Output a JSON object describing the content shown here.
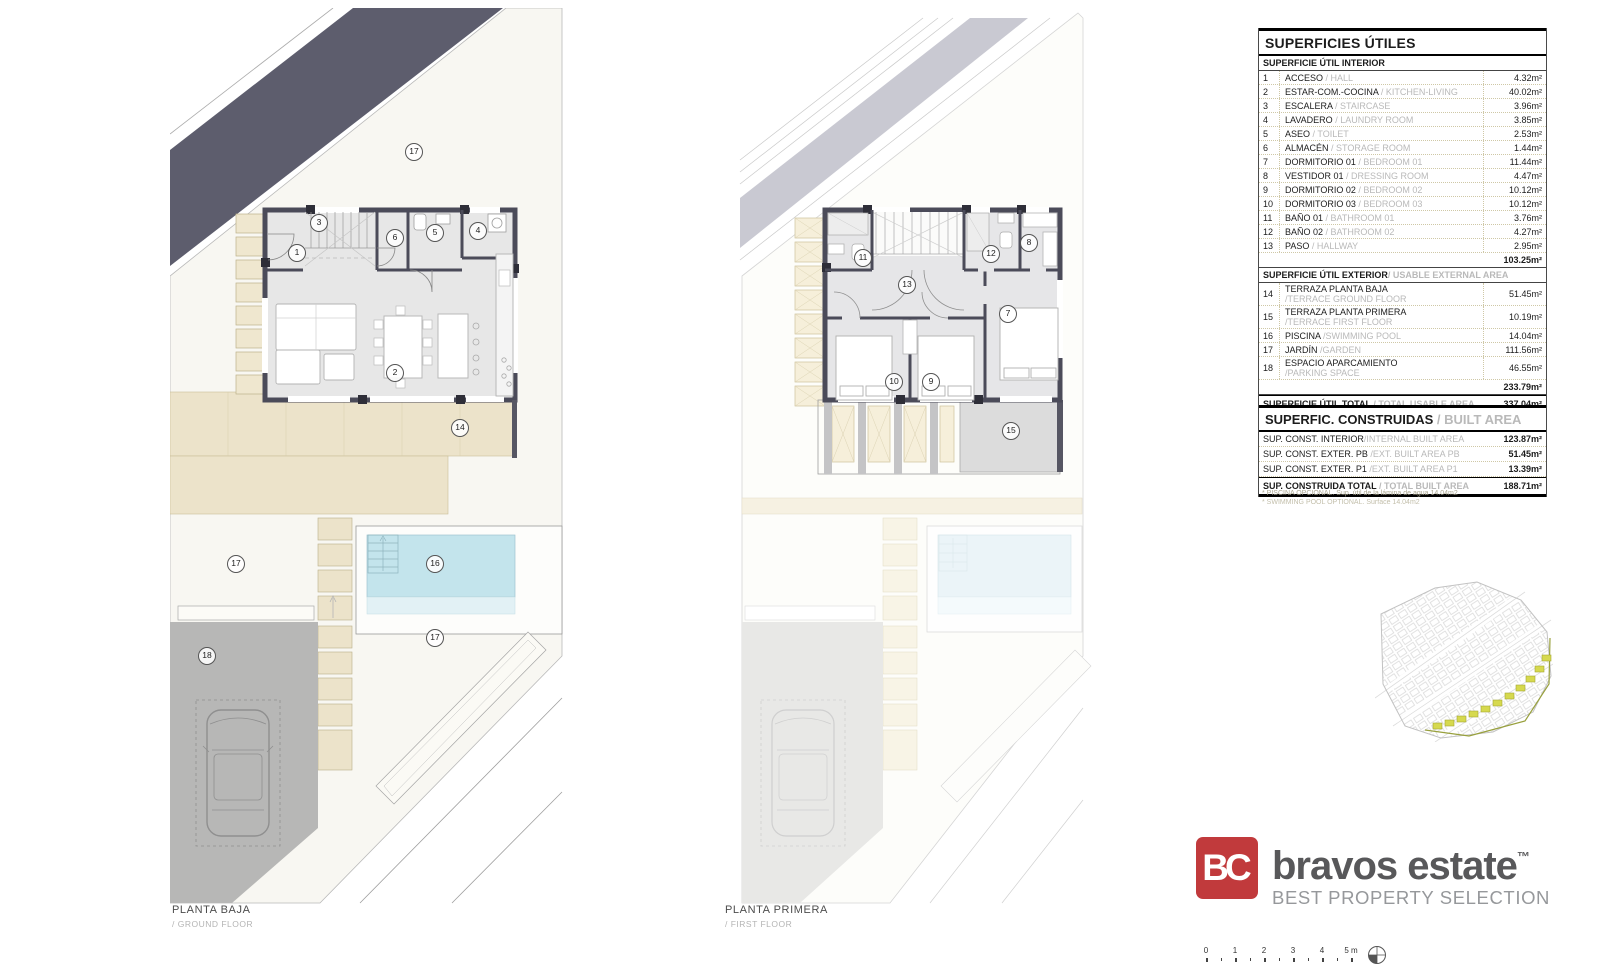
{
  "plans": {
    "ground": {
      "title": "PLANTA BAJA",
      "subtitle": "/ GROUND FLOOR",
      "markers": [
        {
          "n": "17",
          "x": 243,
          "y": 143
        },
        {
          "n": "1",
          "x": 126,
          "y": 244
        },
        {
          "n": "3",
          "x": 148,
          "y": 214
        },
        {
          "n": "6",
          "x": 224,
          "y": 229
        },
        {
          "n": "5",
          "x": 264,
          "y": 224
        },
        {
          "n": "4",
          "x": 307,
          "y": 222
        },
        {
          "n": "2",
          "x": 224,
          "y": 364
        },
        {
          "n": "14",
          "x": 289,
          "y": 419
        },
        {
          "n": "17",
          "x": 65,
          "y": 555
        },
        {
          "n": "16",
          "x": 264,
          "y": 555
        },
        {
          "n": "17",
          "x": 264,
          "y": 629
        },
        {
          "n": "18",
          "x": 36,
          "y": 647
        }
      ]
    },
    "first": {
      "title": "PLANTA PRIMERA",
      "subtitle": "/ FIRST FLOOR",
      "markers": [
        {
          "n": "11",
          "x": 142,
          "y": 249
        },
        {
          "n": "13",
          "x": 186,
          "y": 276
        },
        {
          "n": "12",
          "x": 270,
          "y": 245
        },
        {
          "n": "8",
          "x": 308,
          "y": 234
        },
        {
          "n": "7",
          "x": 287,
          "y": 305
        },
        {
          "n": "10",
          "x": 173,
          "y": 373
        },
        {
          "n": "9",
          "x": 210,
          "y": 373
        },
        {
          "n": "15",
          "x": 290,
          "y": 422
        }
      ]
    }
  },
  "usable_table": {
    "title": "SUPERFICIES ÚTILES",
    "interior_header": "SUPERFICIE ÚTIL INTERIOR",
    "interior_rows": [
      {
        "num": "1",
        "es": "ACCESO",
        "en": "/ HALL",
        "value": "4.32m²"
      },
      {
        "num": "2",
        "es": "ESTAR-COM.-COCINA",
        "en": "/ KITCHEN-LIVING",
        "value": "40.02m²"
      },
      {
        "num": "3",
        "es": "ESCALERA",
        "en": "/ STAIRCASE",
        "value": "3.96m²"
      },
      {
        "num": "4",
        "es": "LAVADERO",
        "en": "/ LAUNDRY ROOM",
        "value": "3.85m²"
      },
      {
        "num": "5",
        "es": "ASEO",
        "en": "/ TOILET",
        "value": "2.53m²"
      },
      {
        "num": "6",
        "es": "ALMACÉN",
        "en": "/ STORAGE ROOM",
        "value": "1.44m²"
      },
      {
        "num": "7",
        "es": "DORMITORIO 01",
        "en": "/ BEDROOM 01",
        "value": "11.44m²"
      },
      {
        "num": "8",
        "es": "VESTIDOR 01",
        "en": "/ DRESSING ROOM",
        "value": "4.47m²"
      },
      {
        "num": "9",
        "es": "DORMITORIO 02",
        "en": "/ BEDROOM 02",
        "value": "10.12m²"
      },
      {
        "num": "10",
        "es": "DORMITORIO 03",
        "en": "/ BEDROOM 03",
        "value": "10.12m²"
      },
      {
        "num": "11",
        "es": "BAÑO 01",
        "en": "/ BATHROOM 01",
        "value": "3.76m²"
      },
      {
        "num": "12",
        "es": "BAÑO 02",
        "en": "/ BATHROOM 02",
        "value": "4.27m²"
      },
      {
        "num": "13",
        "es": "PASO",
        "en": "/ HALLWAY",
        "value": "2.95m²"
      }
    ],
    "interior_subtotal": "103.25m²",
    "exterior_header_es": "SUPERFICIE ÚTIL EXTERIOR",
    "exterior_header_en": "/ USABLE EXTERNAL AREA",
    "exterior_rows": [
      {
        "num": "14",
        "es": "TERRAZA PLANTA BAJA",
        "en": "/TERRACE GROUND FLOOR",
        "two_line": true,
        "value": "51.45m²"
      },
      {
        "num": "15",
        "es": "TERRAZA PLANTA PRIMERA",
        "en": "/TERRACE FIRST FLOOR",
        "two_line": true,
        "value": "10.19m²"
      },
      {
        "num": "16",
        "es": "PISCINA ",
        "en": "/SWIMMING POOL",
        "two_line": false,
        "value": "14.04m²"
      },
      {
        "num": "17",
        "es": "JARDÍN ",
        "en": "/GARDEN",
        "two_line": false,
        "value": "111.56m²"
      },
      {
        "num": "18",
        "es": "ESPACIO APARCAMIENTO",
        "en": "/PARKING SPACE",
        "two_line": true,
        "value": "46.55m²"
      }
    ],
    "exterior_subtotal": "233.79m²",
    "total_es": "SUPERFICIE ÚTIL TOTAL ",
    "total_en": "/ TOTAL USABLE AREA",
    "total_value": "337.04m²"
  },
  "built_table": {
    "title_es": "SUPERFIC. CONSTRUIDAS ",
    "title_en": "/ BUILT AREA",
    "rows": [
      {
        "es": "SUP. CONST. INTERIOR",
        "en": "/INTERNAL BUILT AREA",
        "value": "123.87m²"
      },
      {
        "es": "SUP. CONST. EXTER. PB ",
        "en": "/EXT. BUILT AREA PB",
        "value": "51.45m²"
      },
      {
        "es": "SUP. CONST. EXTER. P1 ",
        "en": "/EXT. BUILT AREA P1",
        "value": "13.39m²"
      }
    ],
    "total_es": "SUP. CONSTRUIDA TOTAL ",
    "total_en": "/ TOTAL BUILT AREA",
    "total_value": "188.71m²",
    "footnotes": [
      "* PISCINA OPCIONAL. Sup. útil de la lámina de agua 14.04m2",
      "* SWIMMING POOL OPTIONAL. Surface 14.04m2"
    ]
  },
  "logo": {
    "mark": "BC",
    "name": "bravos estate",
    "tm": "™",
    "tagline": "BEST PROPERTY SELECTION"
  },
  "scalebar": {
    "labels": [
      "0",
      "1",
      "2",
      "3",
      "4",
      "5 m"
    ]
  },
  "colors": {
    "accent_red": "#c13a3c",
    "wall": "#4b4b59",
    "dark_band": "#5d5d6d",
    "pool": "#c3e4ec",
    "terrace": "#ece3ca",
    "parking": "#b7b7b6",
    "plot_highlight": "#d6d94e"
  }
}
